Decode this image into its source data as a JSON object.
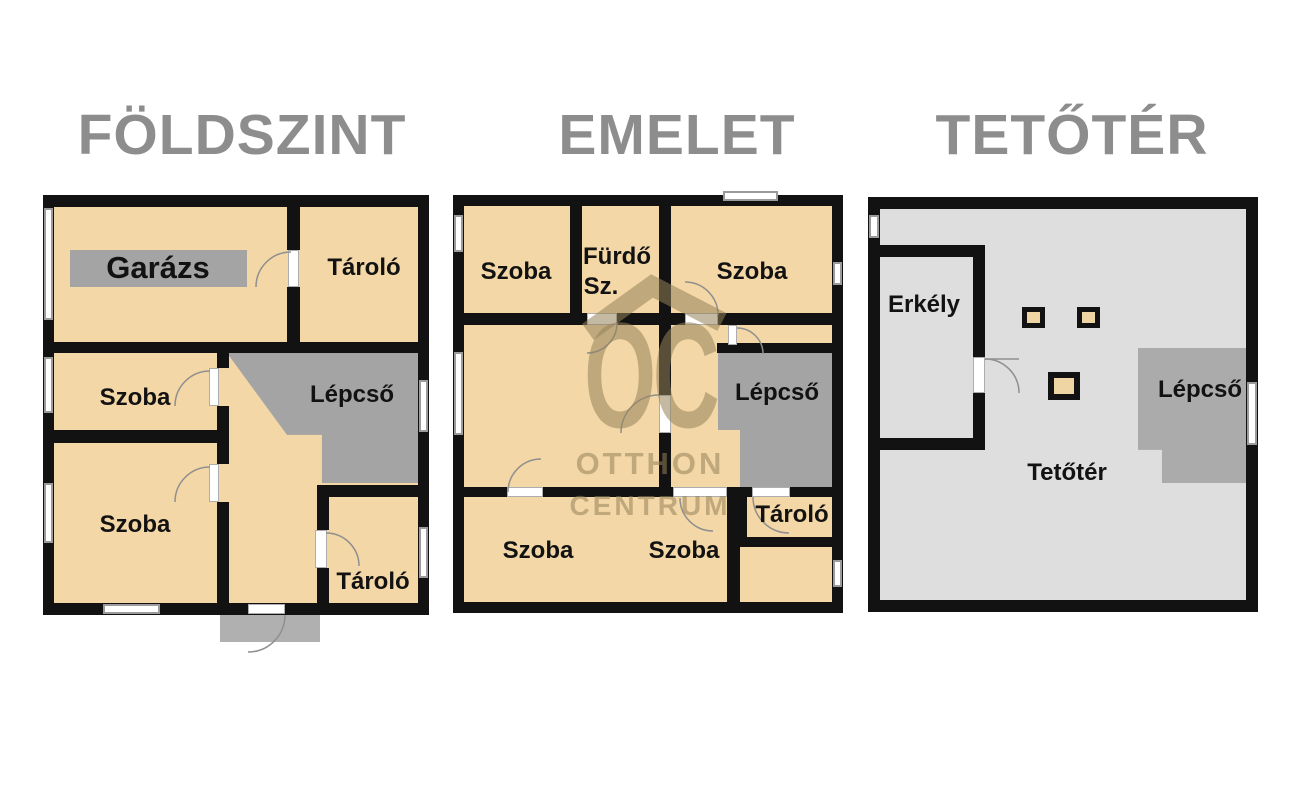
{
  "titles": {
    "floor1": "FÖLDSZINT",
    "floor2": "EMELET",
    "floor3": "TETŐTÉR"
  },
  "floor1": {
    "garage": "Garázs",
    "storage_top": "Tároló",
    "room_mid": "Szoba",
    "stairs": "Lépcső",
    "room_bottom": "Szoba",
    "storage_bottom": "Tároló"
  },
  "floor2": {
    "room_top_left": "Szoba",
    "bathroom_line1": "Fürdő",
    "bathroom_line2": "Sz.",
    "room_top_right": "Szoba",
    "stairs": "Lépcső",
    "storage": "Tároló",
    "room_bottom_left": "Szoba",
    "room_bottom_mid": "Szoba"
  },
  "floor3": {
    "balcony": "Erkély",
    "stairs": "Lépcső",
    "attic": "Tetőtér"
  },
  "watermark": {
    "monogram": "OC",
    "line1": "OTTHON",
    "line2": "CENTRUM"
  },
  "colors": {
    "room_fill": "#f4d7a6",
    "stair_gray": "#a4a4a4",
    "attic_fill": "#dedede",
    "attic_stair_gray": "#ababab",
    "porch_gray": "#b0b0b0",
    "wall": "#121212",
    "title_gray": "#8d8d8d",
    "watermark": "rgba(148,129,90,0.55)"
  }
}
